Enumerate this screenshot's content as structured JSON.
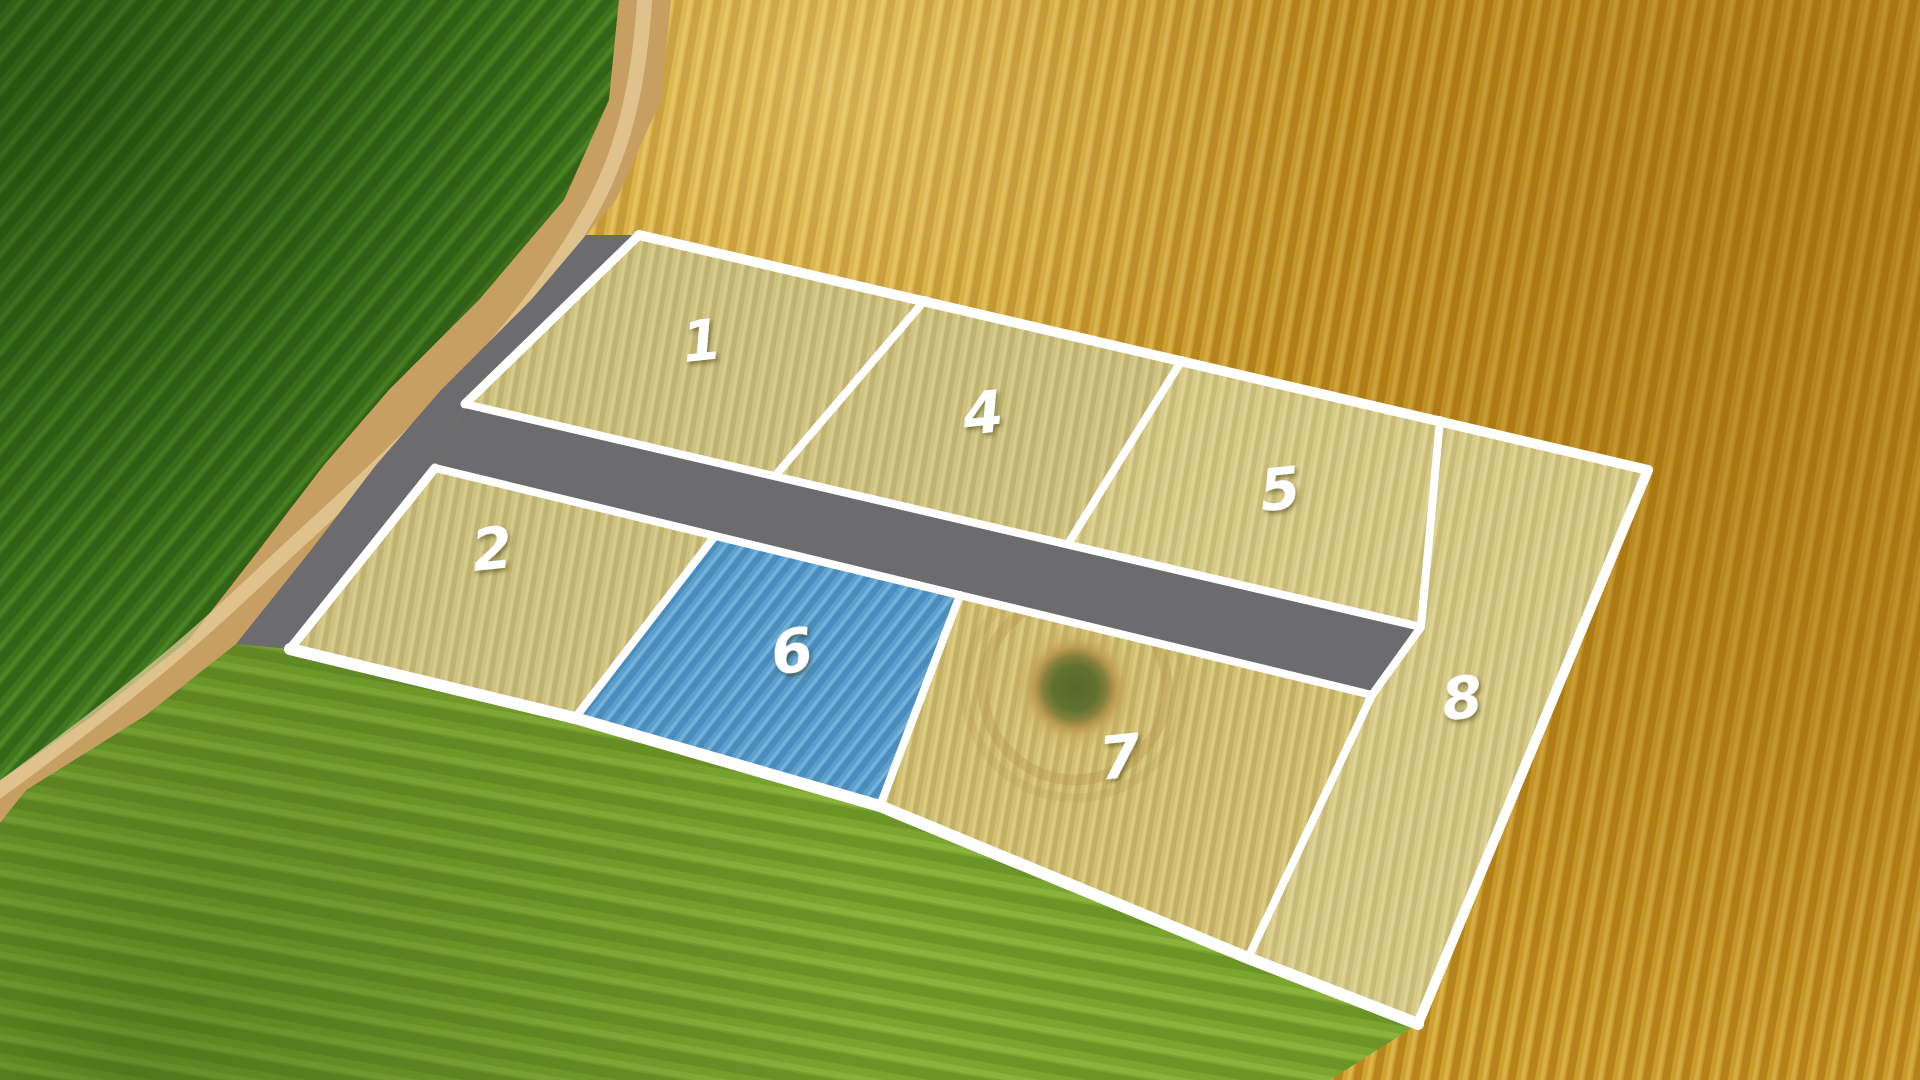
{
  "scene": {
    "type": "aerial-farmland-parcel-map",
    "description": "Aerial drone view of farmland divided into numbered land parcels outlined in white, crossed by a gray access road and a diagonal dirt track",
    "selected_parcel": "6",
    "visible_parcel_count": 7
  },
  "parcels": [
    {
      "id": "1",
      "label": "1",
      "row": "north",
      "highlighted": false
    },
    {
      "id": "2",
      "label": "2",
      "row": "south",
      "highlighted": false
    },
    {
      "id": "4",
      "label": "4",
      "row": "north",
      "highlighted": false
    },
    {
      "id": "5",
      "label": "5",
      "row": "north",
      "highlighted": false
    },
    {
      "id": "6",
      "label": "6",
      "row": "south",
      "highlighted": true
    },
    {
      "id": "7",
      "label": "7",
      "row": "south",
      "highlighted": false
    },
    {
      "id": "8",
      "label": "8",
      "row": "east",
      "highlighted": false
    }
  ],
  "features": {
    "access_road": "gray paved strip between parcel rows",
    "dirt_road": "tan diagonal farm track",
    "crop_mark": "brown circular patch inside parcel 7"
  },
  "colors": {
    "parcel_border": "#ffffff",
    "label_white": "#ffffff",
    "road_gray": "#6c6c6f",
    "parcel_highlight_blue": "#58a1d3",
    "wheat_gold": "#d0a42f",
    "green_dark": "#41781e",
    "green_bright": "#7aa52f",
    "straw_parcel": "#c8bb72",
    "dirt_road_tan": "#c89f63"
  }
}
